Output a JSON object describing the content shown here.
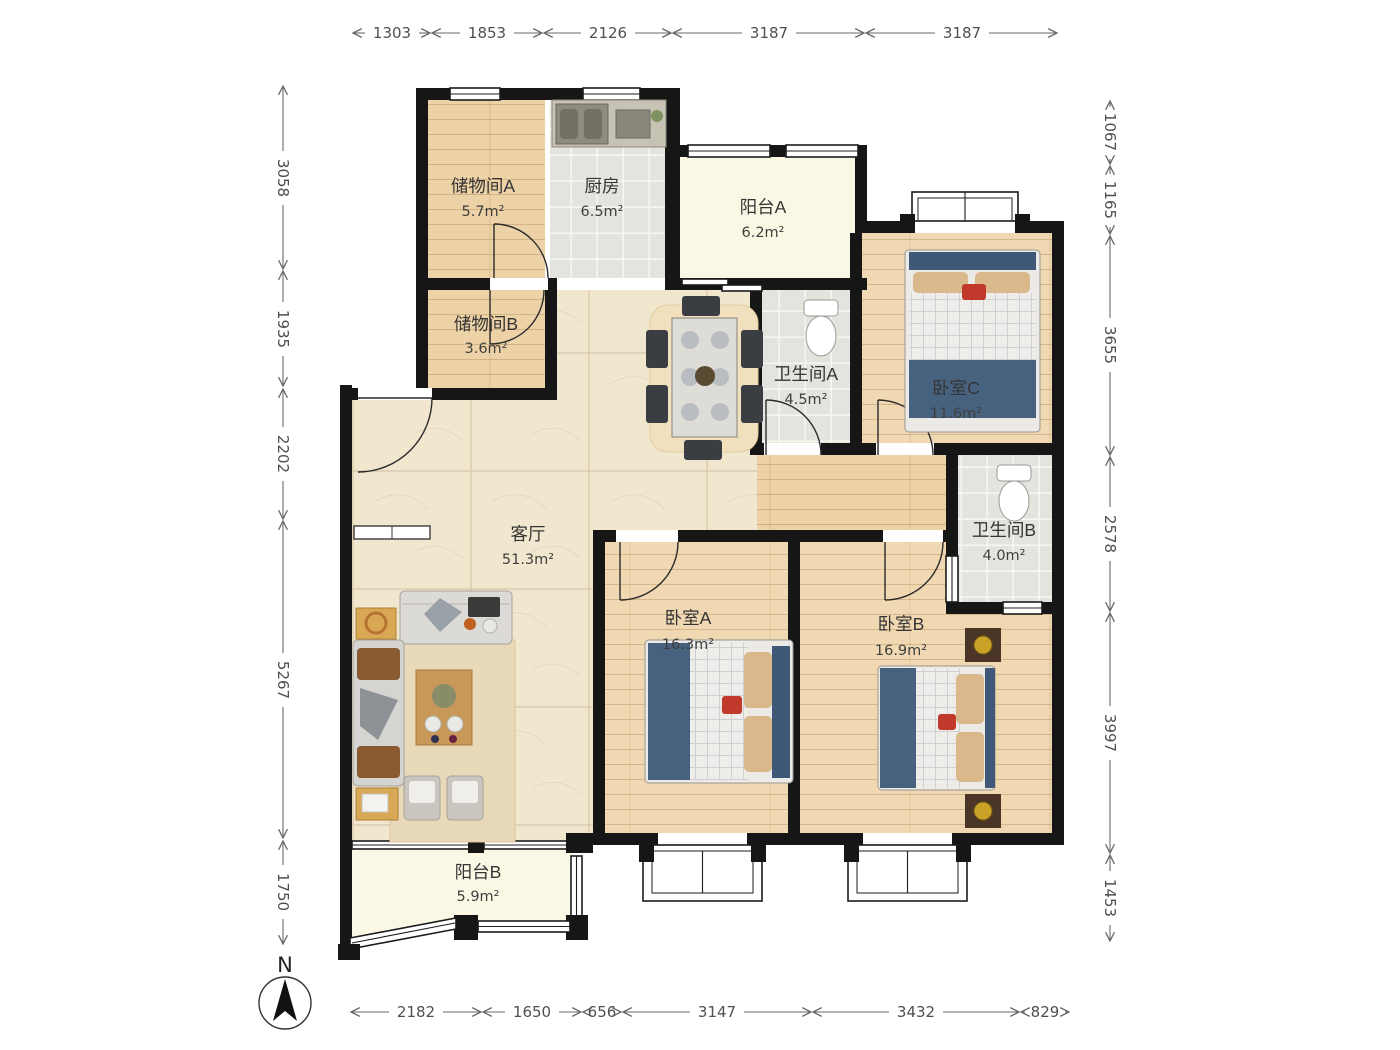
{
  "compass": {
    "label": "N"
  },
  "rooms": [
    {
      "name": "储物间A",
      "area": "5.7m²"
    },
    {
      "name": "厨房",
      "area": "6.5m²"
    },
    {
      "name": "阳台A",
      "area": "6.2m²"
    },
    {
      "name": "储物间B",
      "area": "3.6m²"
    },
    {
      "name": "卫生间A",
      "area": "4.5m²"
    },
    {
      "name": "卧室C",
      "area": "11.6m²"
    },
    {
      "name": "客厅",
      "area": "51.3m²"
    },
    {
      "name": "卫生间B",
      "area": "4.0m²"
    },
    {
      "name": "卧室A",
      "area": "16.3m²"
    },
    {
      "name": "卧室B",
      "area": "16.9m²"
    },
    {
      "name": "阳台B",
      "area": "5.9m²"
    }
  ],
  "dimensions": {
    "top": [
      "1303",
      "1853",
      "2126",
      "3187",
      "3187"
    ],
    "left": [
      "3058",
      "1935",
      "2202",
      "5267",
      "1750"
    ],
    "right": [
      "1067",
      "1165",
      "3655",
      "2578",
      "3997",
      "1453"
    ],
    "bottom": [
      "2182",
      "1650",
      "656",
      "3147",
      "3432",
      "829"
    ]
  },
  "colors": {
    "wall": "#161616",
    "wood_floor": "#ecd2a6",
    "bedroom_floor": "#f0d9b2",
    "marble_floor": "#f1e7cf",
    "tile_floor": "#e4e4de",
    "balcony_floor": "#faf8e4",
    "bed_blanket": "#47627f",
    "pillow": "#d9b98c",
    "counter": "#c6c2b4",
    "table_wood": "#c89858",
    "dim_text": "#4f4f4f"
  }
}
